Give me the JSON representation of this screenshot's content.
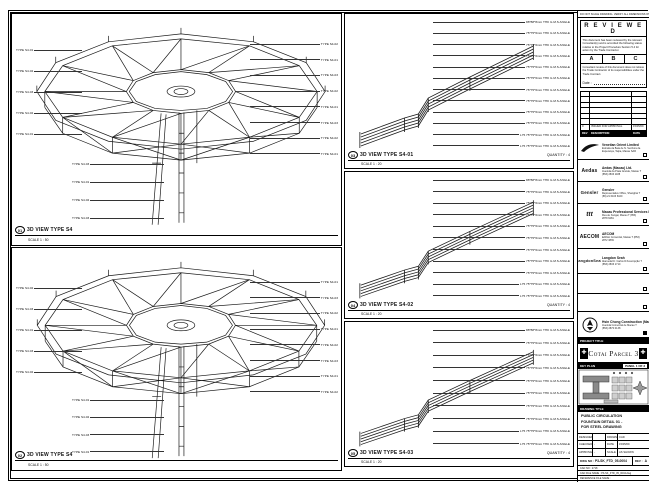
{
  "sheet_note": "DO NOT SCALE DRAWING. VERIFY ALL DIMENSIONS ON SITE.",
  "panels": {
    "left_top": {
      "ref": "01",
      "title": "3D VIEW TYPE S4",
      "scale": "SCALE 1 : 50",
      "labels_left": [
        "TYPE S4-01",
        "TYPE S4-02",
        "TYPE S4-03",
        "TYPE S4-02",
        "TYPE S4-01"
      ],
      "labels_right": [
        "TYPE S4-02",
        "TYPE S4-01",
        "TYPE S4-03",
        "TYPE S4-02",
        "TYPE S4-01",
        "TYPE S4-03",
        "TYPE S4-02",
        "TYPE S4-01"
      ],
      "labels_bottom": [
        "TYPE S4-03",
        "TYPE S4-01",
        "TYPE S4-02",
        "TYPE S4-03"
      ]
    },
    "left_bottom": {
      "ref": "02",
      "title": "3D VIEW TYPE S4",
      "scale": "SCALE 1 : 50",
      "labels_left": [
        "TYPE S4-02",
        "TYPE S4-03",
        "TYPE S4-01",
        "TYPE S4-03",
        "TYPE S4-02"
      ],
      "labels_right": [
        "TYPE S4-01",
        "TYPE S4-03",
        "TYPE S4-02",
        "TYPE S4-01",
        "TYPE S4-02",
        "TYPE S4-03",
        "TYPE S4-01",
        "TYPE S4-02"
      ],
      "labels_bottom": [
        "TYPE S4-01",
        "TYPE S4-02",
        "TYPE S4-03",
        "TYPE S4-01"
      ]
    },
    "mid_1": {
      "ref": "03",
      "title": "3D VIEW TYPE S4-01",
      "scale": "SCALE 1 : 20",
      "quantity": "QUANTITY : 4",
      "annotations": [
        "88*88*8mm THK G.M.S ANGLE",
        "75*75*6mm THK G.M.S ANGLE",
        "75*75*6mm THK G.M.S ANGLE",
        "75*75*6mm THK G.M.S ANGLE",
        "75*75*6mm THK G.M.S ANGLE",
        "75*75*6mm THK G.M.S ANGLE",
        "75*75*6mm THK G.M.S ANGLE",
        "75*75*6mm THK G.M.S ANGLE",
        "75*75*6mm THK G.M.S ANGLE",
        "75*75*6mm THK G.M.S ANGLE",
        "L75 75*75*6mm THK G.M.S ANGLE",
        "L75 75*75*6mm THK G.M.S ANGLE"
      ]
    },
    "mid_2": {
      "ref": "04",
      "title": "3D VIEW TYPE S4-02",
      "scale": "SCALE 1 : 20",
      "quantity": "QUANTITY : 4",
      "annotations": [
        "88*88*8mm THK G.M.S ANGLE",
        "75*75*6mm THK G.M.S ANGLE",
        "75*75*6mm THK G.M.S ANGLE",
        "75*75*6mm THK G.M.S ANGLE",
        "75*75*6mm THK G.M.S ANGLE",
        "75*75*6mm THK G.M.S ANGLE",
        "75*75*6mm THK G.M.S ANGLE",
        "75*75*6mm THK G.M.S ANGLE",
        "75*75*6mm THK G.M.S ANGLE",
        "L75 75*75*6mm THK G.M.S ANGLE",
        "L75 75*75*6mm THK G.M.S ANGLE"
      ]
    },
    "mid_3": {
      "ref": "05",
      "title": "3D VIEW TYPE S4-03",
      "scale": "SCALE 1 : 20",
      "quantity": "QUANTITY : 4",
      "annotations": [
        "88*88*8mm THK G.M.S ANGLE",
        "75*75*6mm THK G.M.S ANGLE",
        "75*75*6mm THK G.M.S ANGLE",
        "75*75*6mm THK G.M.S ANGLE",
        "75*75*6mm THK G.M.S ANGLE",
        "75*75*6mm THK G.M.S ANGLE",
        "75*75*6mm THK G.M.S ANGLE",
        "75*75*6mm THK G.M.S ANGLE",
        "L75 75*75*6mm THK G.M.S ANGLE",
        "L75 75*75*6mm THK G.M.S ANGLE"
      ]
    }
  },
  "titleblock": {
    "reviewed": {
      "title": "R E V I E W E D",
      "body1": "This document has been reviewed by the relevant Consultant(s) and is accorded the following status relative to the Project Procedure Section 5.4 for action by the Trade Contractor.",
      "statuses": [
        "A",
        "B",
        "C"
      ],
      "body2": "Consultant review of this document does not relieve the Trade Contractor of its responsibilities under the Trade Contract.",
      "date_label": "Date :"
    },
    "revisions": {
      "header_rev": "REV",
      "header_desc": "DESCRIPTION",
      "header_date": "DATE",
      "row_rev": "0",
      "row_desc": "ISSUED FOR APPROVAL",
      "row_date": "15/05/09"
    },
    "consultants": {
      "venetian": {
        "name": "Venetian Orient Limited",
        "addr": "Estrada da Baía de N. Senhora da Esperança, Taipa, Macau SAR"
      },
      "aedas": {
        "logo": "Aedas",
        "name": "Aedas (Macau) Ltd.",
        "addr": "Avenida da Praia Grande, Macau  T (853) 2833 1188"
      },
      "gensler": {
        "logo": "Gensler",
        "name": "Gensler",
        "addr": "Representative Office, Shanghai  T (86) 21 6103 6100"
      },
      "mps": {
        "logo": "ttt",
        "name": "Macau Professional Services Ltd.",
        "addr": "Rua de Xangai, Macau  T (853) 2878 6281"
      },
      "aecom": {
        "logo": "AECOM",
        "name": "AECOM",
        "addr": "Edificio Comercial, Macau  T (853) 2872 3839"
      },
      "langdon": {
        "logo": "LangdonSeah",
        "name": "Langdon Seah",
        "addr": "Alameda Dr. Carlos D'Assumpção  T (853) 2833 1710"
      },
      "contractor": {
        "name": "Hsin Chong Construction (Macau) Ltd.",
        "addr": "Avenida Comercial de Macau  T (853) 2870 0138"
      }
    },
    "project_title_label": "PROJECT TITLE",
    "project_title": "Cotai Parcel 3",
    "key_plan_label": "KEY PLAN",
    "panel_note": "PANEL 1 OF 3",
    "drawing_title_label": "DRAWING TITLE",
    "drawing_title_line1": "PUBLIC CIRCULATION",
    "drawing_title_line2": "FOUNTAIN DETAIL 01 -",
    "drawing_title_line3": "FOR STEEL DRAWING",
    "info": {
      "designed_label": "DESIGNED",
      "designed": "",
      "drawn_label": "DRAWN",
      "drawn": "CAD",
      "checked_label": "CHECKED",
      "checked": "-",
      "date_label": "DATE",
      "date": "15/05/09",
      "approved_label": "APPROVED",
      "approved": "-",
      "scale_label": "SCALE",
      "scale": "AS SHOWN"
    },
    "dwg_no_label": "DWG NO :",
    "dwg_no": "P3-SK_FTD_05-0004",
    "rev_label": "REV :",
    "rev": "A",
    "cad_row1": "CAD NO : 2718",
    "cad_row2": "CAD FILE NAME : P3-SK_FTD_05_0004.dwg",
    "cad_row3": "REFERENCE FILE NAME :"
  }
}
